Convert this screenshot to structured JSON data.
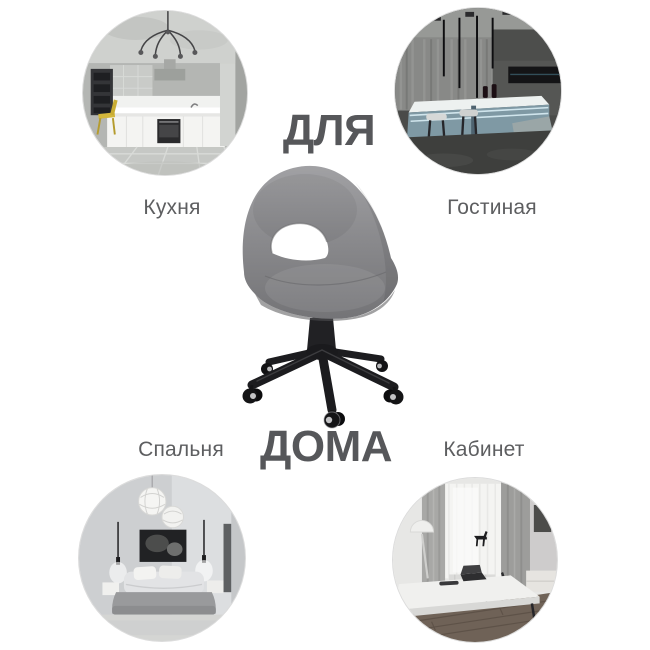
{
  "titles": {
    "top": "ДЛЯ",
    "bottom": "ДОМА"
  },
  "rooms": [
    {
      "id": "kitchen",
      "label": "Кухня"
    },
    {
      "id": "living-room",
      "label": "Гостиная"
    },
    {
      "id": "bedroom",
      "label": "Спальня"
    },
    {
      "id": "office",
      "label": "Кабинет"
    }
  ],
  "product": {
    "name": "grey velvet swivel office chair",
    "colors": {
      "upholstery": "#8b8b8e",
      "base": "#1c1c1f",
      "gas_lift": "#9da0a3"
    }
  },
  "theme": {
    "background": "#ffffff",
    "text_color": "#56575a"
  }
}
